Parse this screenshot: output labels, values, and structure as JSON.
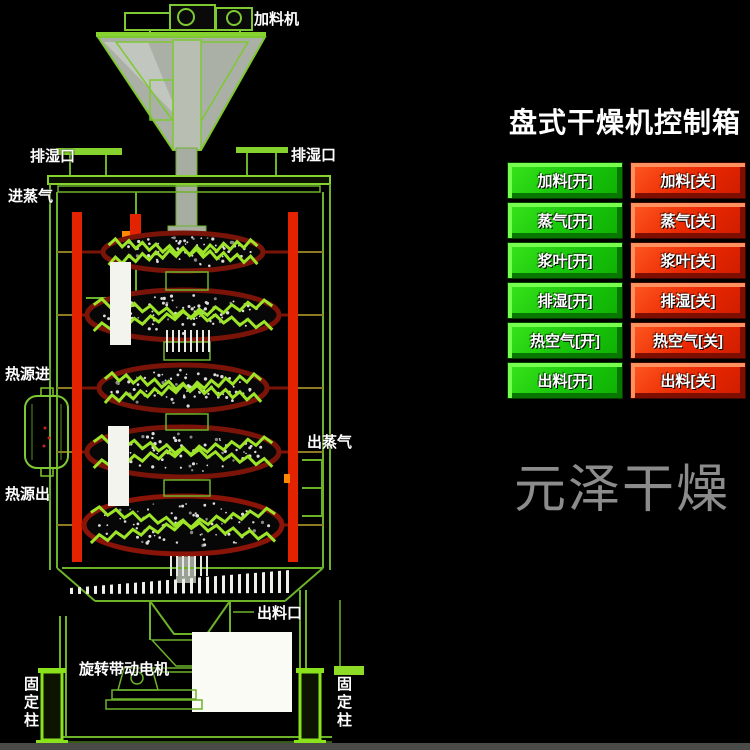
{
  "watermark": "元泽干燥",
  "machine": {
    "labels": {
      "feeder": "加料机",
      "vent_left": "排湿口",
      "vent_right": "排湿口",
      "steam_in": "进蒸气",
      "heat_in": "热源进",
      "heat_out": "热源出",
      "steam_out": "出蒸气",
      "discharge": "出料口",
      "drive_motor": "旋转带动电机",
      "fixed_column_left": "固定柱",
      "fixed_column_right": "固定柱"
    }
  },
  "control_panel": {
    "title": "盘式干燥机控制箱",
    "buttons": [
      {
        "name": "feed",
        "on": "加料[开]",
        "off": "加料[关]"
      },
      {
        "name": "steam",
        "on": "蒸气[开]",
        "off": "蒸气[关]"
      },
      {
        "name": "paddle",
        "on": "浆叶[开]",
        "off": "浆叶[关]"
      },
      {
        "name": "dehumidify",
        "on": "排湿[开]",
        "off": "排湿[关]"
      },
      {
        "name": "hot_air",
        "on": "热空气[开]",
        "off": "热空气[关]"
      },
      {
        "name": "discharge",
        "on": "出料[开]",
        "off": "出料[关]"
      }
    ],
    "colors": {
      "on_button": "#1ed30c",
      "off_button": "#ee2600",
      "line_green": "#7ec832",
      "pipe_red": "#e32200"
    }
  }
}
